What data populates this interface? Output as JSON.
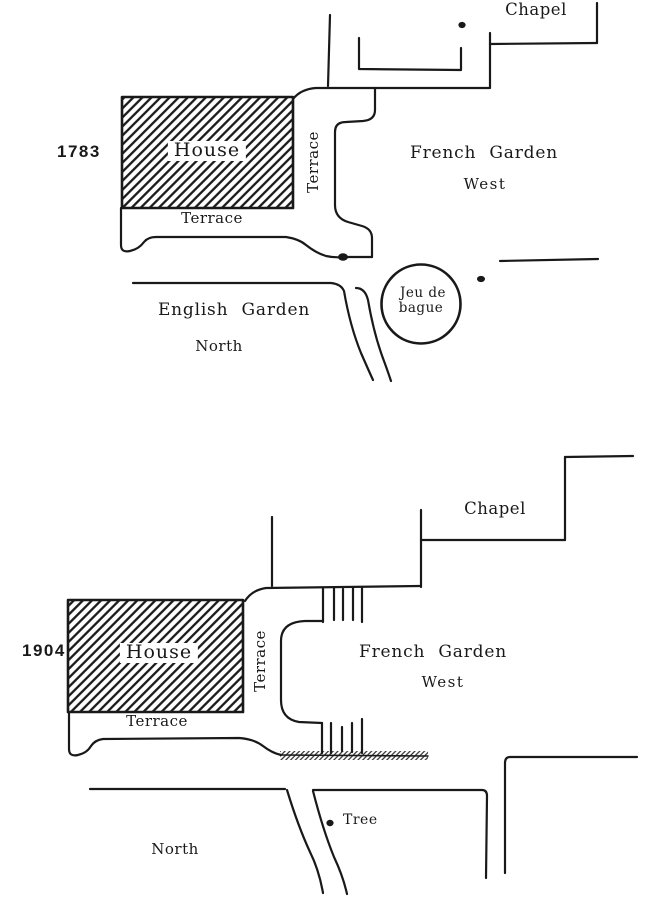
{
  "colors": {
    "background": "#ffffff",
    "ink": "#191919"
  },
  "plans": [
    {
      "year": "1783",
      "labels": {
        "chapel": "Chapel",
        "house": "House",
        "terrace_side": "Terrace",
        "terrace_front": "Terrace",
        "french_garden": "French Garden",
        "french_garden_direction": "West",
        "english_garden": "English Garden",
        "english_garden_direction": "North",
        "jeu_de_bague_line1": "Jeu de",
        "jeu_de_bague_line2": "bague"
      }
    },
    {
      "year": "1904",
      "labels": {
        "chapel": "Chapel",
        "house": "House",
        "terrace_side": "Terrace",
        "terrace_front": "Terrace",
        "french_garden": "French Garden",
        "french_garden_direction": "West",
        "north": "North",
        "tree": "Tree"
      }
    }
  ]
}
